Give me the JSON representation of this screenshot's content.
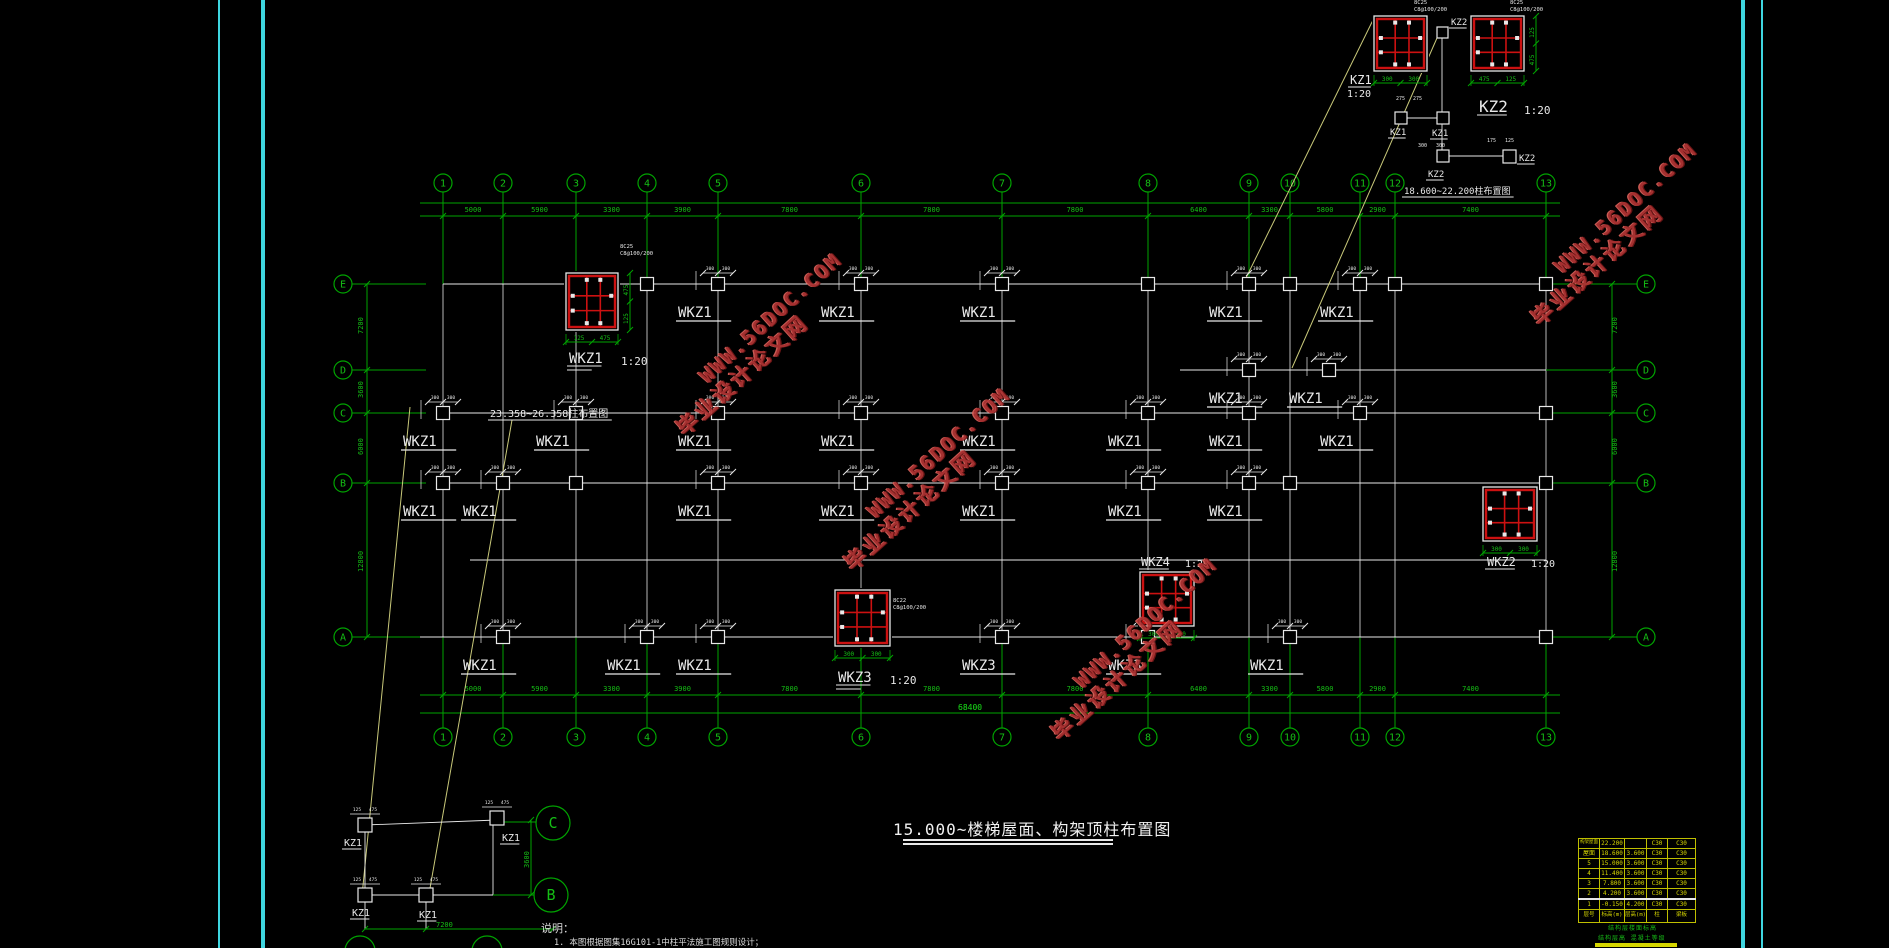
{
  "app": {
    "type": "cad-structural-drawing"
  },
  "colors": {
    "background": "#000000",
    "axis_green": "#00A400",
    "text_green": "#15BF15",
    "white": "#E8E8E8",
    "red": "#CC1111",
    "cyan_border": "#3FD6E0",
    "table_yellow": "#BFBF00",
    "table_text_yellow": "#D6D600",
    "leader_yellow": "#C9C97A",
    "watermark_red": "#B23434"
  },
  "title_block": {
    "text": "15.000~楼梯屋面、构架顶柱布置图"
  },
  "captions": {
    "corner_detail": "18.600~22.200柱布置图",
    "mid_plan": "23.358~26.358柱布置图"
  },
  "notes": {
    "heading": "说明：",
    "items": [
      "1. 本图根据图集16G101-1中柱平法施工图规则设计；"
    ]
  },
  "watermark": {
    "line1": "WWW.56DOC.COM",
    "line2": "毕业设计论文网",
    "rotation_deg": -42,
    "instances": [
      {
        "x": 760,
        "y": 345
      },
      {
        "x": 928,
        "y": 480
      },
      {
        "x": 1135,
        "y": 650
      },
      {
        "x": 1615,
        "y": 235
      }
    ]
  },
  "axes": {
    "cols": [
      {
        "n": "1",
        "x": 443
      },
      {
        "n": "2",
        "x": 503
      },
      {
        "n": "3",
        "x": 576
      },
      {
        "n": "4",
        "x": 647
      },
      {
        "n": "5",
        "x": 718
      },
      {
        "n": "6",
        "x": 861
      },
      {
        "n": "7",
        "x": 1002
      },
      {
        "n": "8",
        "x": 1148
      },
      {
        "n": "9",
        "x": 1249
      },
      {
        "n": "10",
        "x": 1290
      },
      {
        "n": "11",
        "x": 1360
      },
      {
        "n": "12",
        "x": 1395
      },
      {
        "n": "13",
        "x": 1546
      }
    ],
    "rows": [
      {
        "n": "E",
        "y": 284
      },
      {
        "n": "D",
        "y": 370
      },
      {
        "n": "C",
        "y": 413
      },
      {
        "n": "B",
        "y": 483
      },
      {
        "n": "A",
        "y": 637
      }
    ],
    "top_circle_y": 183,
    "bottom_circle_y": 737,
    "left_circle_x": 343,
    "right_circle_x": 1646,
    "bubble_r": 9,
    "dims_top": [
      "5000",
      "5900",
      "3300",
      "3900",
      "7800",
      "7800",
      "7800",
      "6400",
      "3300",
      "5800",
      "2900",
      "7400"
    ],
    "dims_bottom": [
      "5000",
      "5900",
      "3300",
      "3900",
      "7800",
      "7800",
      "7800",
      "6400",
      "3300",
      "5800",
      "2900",
      "7400"
    ],
    "dims_bottom_total": "68400",
    "dims_left": [
      "7200",
      "3600",
      "6000",
      "12800"
    ],
    "dims_right": [
      "7200",
      "3600",
      "6000",
      "12800"
    ]
  },
  "plan": {
    "node_dim_marks": [
      "300",
      "300"
    ],
    "white_lines": [
      [
        443,
        284,
        1546,
        284
      ],
      [
        1180,
        370,
        1546,
        370
      ],
      [
        443,
        413,
        1546,
        413
      ],
      [
        443,
        483,
        1546,
        483
      ],
      [
        470,
        560,
        1546,
        560
      ],
      [
        420,
        637,
        1546,
        637
      ],
      [
        1442,
        38,
        1442,
        150
      ],
      [
        1401,
        118,
        1443,
        118
      ],
      [
        1449,
        156,
        1503,
        156
      ]
    ],
    "nodes": [
      {
        "x": 647,
        "y": 284
      },
      {
        "x": 718,
        "y": 284,
        "t": "WKZ1"
      },
      {
        "x": 861,
        "y": 284,
        "t": "WKZ1"
      },
      {
        "x": 1002,
        "y": 284,
        "t": "WKZ1"
      },
      {
        "x": 1148,
        "y": 284
      },
      {
        "x": 1249,
        "y": 284,
        "t": "WKZ1"
      },
      {
        "x": 1290,
        "y": 284
      },
      {
        "x": 1360,
        "y": 284,
        "t": "WKZ1"
      },
      {
        "x": 1395,
        "y": 284
      },
      {
        "x": 1546,
        "y": 284
      },
      {
        "x": 1249,
        "y": 370,
        "t": "WKZ1"
      },
      {
        "x": 1329,
        "y": 370,
        "t": "WKZ1"
      },
      {
        "x": 443,
        "y": 413,
        "t": "WKZ1"
      },
      {
        "x": 576,
        "y": 413,
        "t": "WKZ1"
      },
      {
        "x": 718,
        "y": 413,
        "t": "WKZ1"
      },
      {
        "x": 861,
        "y": 413,
        "t": "WKZ1"
      },
      {
        "x": 1002,
        "y": 413,
        "t": "WKZ1"
      },
      {
        "x": 1148,
        "y": 413,
        "t": "WKZ1"
      },
      {
        "x": 1249,
        "y": 413,
        "t": "WKZ1"
      },
      {
        "x": 1360,
        "y": 413,
        "t": "WKZ1"
      },
      {
        "x": 1546,
        "y": 413
      },
      {
        "x": 443,
        "y": 483,
        "t": "WKZ1"
      },
      {
        "x": 503,
        "y": 483,
        "t": "WKZ1"
      },
      {
        "x": 576,
        "y": 483
      },
      {
        "x": 718,
        "y": 483,
        "t": "WKZ1"
      },
      {
        "x": 861,
        "y": 483,
        "t": "WKZ1"
      },
      {
        "x": 1002,
        "y": 483,
        "t": "WKZ1"
      },
      {
        "x": 1148,
        "y": 483,
        "t": "WKZ1"
      },
      {
        "x": 1249,
        "y": 483,
        "t": "WKZ1"
      },
      {
        "x": 1290,
        "y": 483
      },
      {
        "x": 1546,
        "y": 483
      },
      {
        "x": 503,
        "y": 637,
        "t": "WKZ1"
      },
      {
        "x": 647,
        "y": 637,
        "t": "WKZ1"
      },
      {
        "x": 718,
        "y": 637,
        "t": "WKZ1"
      },
      {
        "x": 1002,
        "y": 637,
        "t": "WKZ3"
      },
      {
        "x": 1148,
        "y": 637,
        "t": "WKZ3"
      },
      {
        "x": 1290,
        "y": 637,
        "t": "WKZ1"
      },
      {
        "x": 1546,
        "y": 637
      }
    ],
    "leader_lines": [
      [
        1374,
        18,
        1244,
        282
      ],
      [
        1437,
        38,
        1292,
        368
      ],
      [
        410,
        407,
        362,
        896
      ],
      [
        512,
        420,
        429,
        894
      ]
    ]
  },
  "detail_boxes": [
    {
      "x": 566,
      "y": 273,
      "w": 52,
      "h": 57,
      "dims_h": [
        "125",
        "475"
      ],
      "dims_v": [
        "475",
        "125"
      ],
      "ann": {
        "x": 620,
        "y": 248,
        "lines": [
          "8C25",
          "C8@100/200"
        ]
      }
    },
    {
      "x": 835,
      "y": 590,
      "w": 55,
      "h": 56,
      "dims_h": [
        "300",
        "300"
      ],
      "ann": {
        "x": 893,
        "y": 602,
        "lines": [
          "8C22",
          "C8@100/200"
        ]
      }
    },
    {
      "x": 1140,
      "y": 572,
      "w": 54,
      "h": 54,
      "dims_h": [
        "300",
        "300"
      ]
    },
    {
      "x": 1483,
      "y": 487,
      "w": 54,
      "h": 54,
      "dims_h": [
        "300",
        "300"
      ]
    },
    {
      "x": 1374,
      "y": 16,
      "w": 53,
      "h": 55,
      "dims_h": [
        "300",
        "300"
      ],
      "ann": {
        "x": 1414,
        "y": 4,
        "lines": [
          "8C25",
          "C8@100/200"
        ]
      }
    },
    {
      "x": 1471,
      "y": 16,
      "w": 53,
      "h": 55,
      "dims_h": [
        "475",
        "125"
      ],
      "dims_v": [
        "125",
        "475"
      ],
      "ann": {
        "x": 1510,
        "y": 4,
        "lines": [
          "8C25",
          "C8@100/200"
        ]
      }
    }
  ],
  "small_squares": [
    [
      1437,
      27,
      11
    ],
    [
      1395,
      112,
      12
    ],
    [
      1437,
      112,
      12
    ],
    [
      1437,
      150,
      12
    ],
    [
      1503,
      150,
      13
    ]
  ],
  "stair_detail": {
    "nodes": [
      {
        "x": 365,
        "y": 825,
        "t": "KZ1"
      },
      {
        "x": 497,
        "y": 818,
        "t": "KZ1"
      },
      {
        "x": 365,
        "y": 895,
        "t": "KZ1"
      },
      {
        "x": 426,
        "y": 895,
        "t": "KZ1"
      }
    ],
    "node_dim_marks": [
      "125",
      "475"
    ],
    "white_lines": [
      [
        365,
        825,
        497,
        820
      ],
      [
        365,
        825,
        365,
        895
      ],
      [
        365,
        895,
        493,
        895
      ],
      [
        493,
        818,
        493,
        895
      ],
      [
        365,
        902,
        365,
        929
      ],
      [
        426,
        902,
        426,
        929
      ]
    ],
    "green_lines": [
      [
        504,
        822,
        536,
        822
      ],
      [
        493,
        895,
        534,
        895
      ],
      [
        531,
        820,
        531,
        895
      ],
      [
        365,
        929,
        553,
        929
      ]
    ],
    "bubbles": [
      {
        "n": "C",
        "x": 553,
        "y": 823,
        "r": 17
      },
      {
        "n": "B",
        "x": 551,
        "y": 895,
        "r": 17
      }
    ],
    "partial_bubbles": [
      {
        "x": 360,
        "y": 951,
        "r": 15
      },
      {
        "x": 487,
        "y": 951,
        "r": 15
      }
    ],
    "dim_bottom": "7200",
    "dim_vertical": "3600"
  },
  "svg_texts": [
    {
      "t": "KZ1",
      "x": 1350,
      "y": 84,
      "s": 12,
      "c": "w",
      "u": 1
    },
    {
      "t": "1:20",
      "x": 1347,
      "y": 97,
      "s": 10,
      "c": "w"
    },
    {
      "t": "KZ2",
      "x": 1479,
      "y": 112,
      "s": 16,
      "c": "w",
      "u": 1
    },
    {
      "t": "1:20",
      "x": 1524,
      "y": 114,
      "s": 11,
      "c": "w"
    },
    {
      "t": "KZ2",
      "x": 1451,
      "y": 25,
      "s": 9,
      "c": "w",
      "u": 1
    },
    {
      "t": "KZ1",
      "x": 1390,
      "y": 135,
      "s": 9,
      "c": "w",
      "u": 1
    },
    {
      "t": "KZ1",
      "x": 1432,
      "y": 136,
      "s": 9,
      "c": "w",
      "u": 1
    },
    {
      "t": "KZ2",
      "x": 1428,
      "y": 177,
      "s": 9,
      "c": "w",
      "u": 1
    },
    {
      "t": "KZ2",
      "x": 1519,
      "y": 161,
      "s": 9,
      "c": "w",
      "u": 1
    },
    {
      "t": "18.600~22.200柱布置图",
      "x": 1404,
      "y": 194,
      "s": 9,
      "c": "w",
      "u": 1
    },
    {
      "t": "275",
      "x": 1396,
      "y": 100,
      "s": 5,
      "c": "w"
    },
    {
      "t": "275",
      "x": 1413,
      "y": 100,
      "s": 5,
      "c": "w"
    },
    {
      "t": "300",
      "x": 1418,
      "y": 147,
      "s": 5,
      "c": "w"
    },
    {
      "t": "300",
      "x": 1436,
      "y": 147,
      "s": 5,
      "c": "w"
    },
    {
      "t": "175",
      "x": 1487,
      "y": 142,
      "s": 5,
      "c": "w"
    },
    {
      "t": "125",
      "x": 1505,
      "y": 142,
      "s": 5,
      "c": "w"
    },
    {
      "t": "WKZ1",
      "x": 569,
      "y": 363,
      "s": 14,
      "c": "w",
      "u": 2
    },
    {
      "t": "1:20",
      "x": 621,
      "y": 365,
      "s": 11,
      "c": "w"
    },
    {
      "t": "WKZ3",
      "x": 838,
      "y": 682,
      "s": 14,
      "c": "w",
      "u": 2
    },
    {
      "t": "1:20",
      "x": 890,
      "y": 684,
      "s": 11,
      "c": "w"
    },
    {
      "t": "WKZ4",
      "x": 1141,
      "y": 566,
      "s": 12,
      "c": "w",
      "u": 1
    },
    {
      "t": "1:20",
      "x": 1185,
      "y": 567,
      "s": 10,
      "c": "w"
    },
    {
      "t": "WKZ2",
      "x": 1487,
      "y": 566,
      "s": 12,
      "c": "w",
      "u": 1
    },
    {
      "t": "1:20",
      "x": 1531,
      "y": 567,
      "s": 10,
      "c": "w"
    },
    {
      "t": "23.358~26.358柱布置图",
      "x": 490,
      "y": 417,
      "s": 10,
      "c": "w",
      "u": 1
    },
    {
      "t": "KZ1",
      "x": 344,
      "y": 846,
      "s": 10,
      "c": "w",
      "u": 1
    },
    {
      "t": "KZ1",
      "x": 502,
      "y": 841,
      "s": 10,
      "c": "w",
      "u": 1
    },
    {
      "t": "KZ1",
      "x": 352,
      "y": 916,
      "s": 10,
      "c": "w",
      "u": 1
    },
    {
      "t": "KZ1",
      "x": 419,
      "y": 918,
      "s": 10,
      "c": "w",
      "u": 1
    },
    {
      "t": "7200",
      "x": 436,
      "y": 927,
      "s": 7,
      "c": "g"
    },
    {
      "t": "3600",
      "x": 529,
      "y": 868,
      "s": 7,
      "c": "g",
      "r": -90
    },
    {
      "t": "7200",
      "x": 363,
      "y": 334,
      "s": 7,
      "c": "g",
      "r": -90
    },
    {
      "t": "3600",
      "x": 363,
      "y": 398,
      "s": 7,
      "c": "g",
      "r": -90
    },
    {
      "t": "6000",
      "x": 363,
      "y": 455,
      "s": 7,
      "c": "g",
      "r": -90
    },
    {
      "t": "12800",
      "x": 363,
      "y": 572,
      "s": 7,
      "c": "g",
      "r": -90
    },
    {
      "t": "7200",
      "x": 1617,
      "y": 334,
      "s": 7,
      "c": "g",
      "r": -90
    },
    {
      "t": "3600",
      "x": 1617,
      "y": 398,
      "s": 7,
      "c": "g",
      "r": -90
    },
    {
      "t": "6000",
      "x": 1617,
      "y": 455,
      "s": 7,
      "c": "g",
      "r": -90
    },
    {
      "t": "12800",
      "x": 1617,
      "y": 572,
      "s": 7,
      "c": "g",
      "r": -90
    },
    {
      "t": "68400",
      "x": 958,
      "y": 710,
      "s": 8,
      "c": "g"
    }
  ],
  "elevation_table": {
    "x": 1578,
    "y": 838,
    "col_widths": [
      20,
      24,
      21,
      20,
      27
    ],
    "header": [
      "层号",
      "标高(m)",
      "层高(m)",
      "柱",
      "梁板"
    ],
    "rows": [
      [
        "构架屋面",
        "22.200",
        "",
        "C30",
        "C30"
      ],
      [
        "屋面",
        "18.600",
        "3.600",
        "C30",
        "C30"
      ],
      [
        "5",
        "15.000",
        "3.600",
        "C30",
        "C30"
      ],
      [
        "4",
        "11.400",
        "3.600",
        "C30",
        "C30"
      ],
      [
        "3",
        "7.800",
        "3.600",
        "C30",
        "C30"
      ],
      [
        "2",
        "4.200",
        "3.600",
        "C30",
        "C30"
      ],
      [
        "1",
        "-0.150",
        "4.200",
        "C30",
        "C30"
      ]
    ],
    "white_separator_before_row": 6,
    "footer": [
      "结构层楼面标高",
      "结构层高  混凝土等级"
    ]
  }
}
